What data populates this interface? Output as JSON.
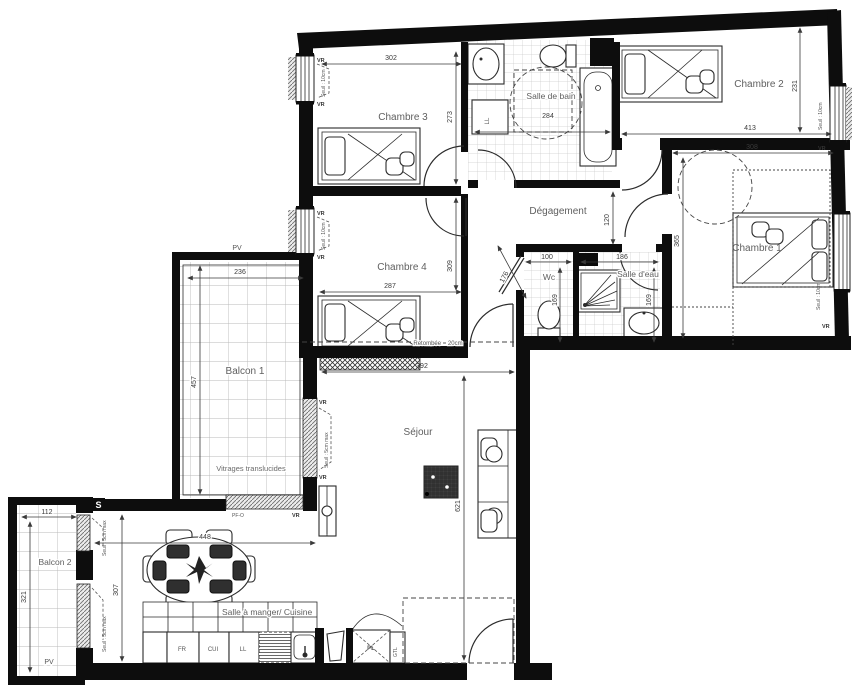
{
  "rooms": {
    "chambre1": {
      "label": "Chambre 1",
      "width": "308",
      "depth": "365"
    },
    "chambre2": {
      "label": "Chambre 2",
      "width": "413",
      "depth": "231"
    },
    "chambre3": {
      "label": "Chambre 3",
      "width": "302",
      "depth": "273"
    },
    "chambre4": {
      "label": "Chambre 4",
      "width": "287",
      "depth": "309"
    },
    "salle_de_bain": {
      "label": "Salle de bain",
      "width": "284"
    },
    "degagement": {
      "label": "Dégagement",
      "width": "120"
    },
    "wc": {
      "label": "Wc",
      "width": "100",
      "depth": "169"
    },
    "salle_deau": {
      "label": "Salle d'eau",
      "width": "186",
      "depth": "169"
    },
    "sejour": {
      "label": "Séjour",
      "width": "392",
      "depth": "621"
    },
    "salle_a_manger": {
      "label": "Salle à manger/ Cuisine",
      "width": "448",
      "depth": "307"
    },
    "balcon1": {
      "label": "Balcon 1",
      "width": "236",
      "depth": "457"
    },
    "balcon2": {
      "label": "Balcon 2",
      "width": "112",
      "depth": "321"
    }
  },
  "dims": {
    "hall_diag": "176"
  },
  "annotations": {
    "vr": "VR",
    "pv": "PV",
    "pf_o": "PF-O",
    "s_mark": "S",
    "seuil_10": "Seuil : 10cm",
    "seuil_5": "Seuil : 5cm max",
    "vitrages": "Vitrages translucides",
    "retombee": "Retombée = 20cm",
    "gtl": "GTL",
    "pl": "PL",
    "ll": "LL",
    "kitchen_units": [
      "FR",
      "CUI",
      "LL"
    ]
  },
  "colors": {
    "wall": "#0d0d0d",
    "line": "#2b2b2b",
    "dim": "#3a3a3a",
    "label": "#5f5f5f",
    "tile": "#c9c9c9"
  }
}
